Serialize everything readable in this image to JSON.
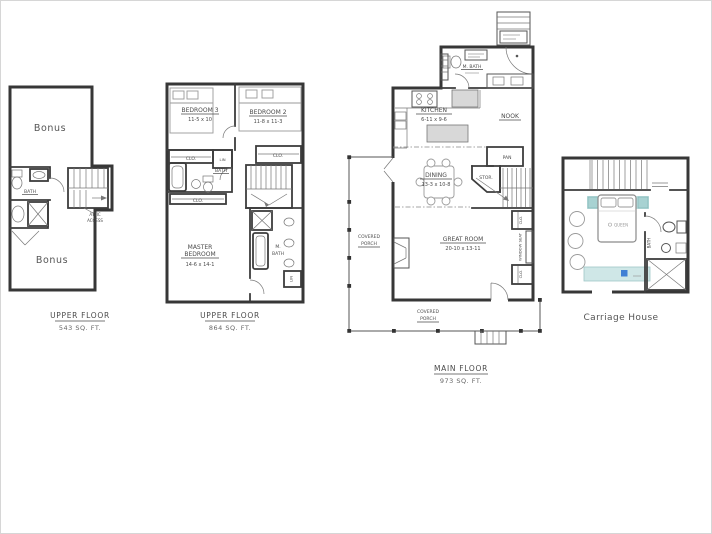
{
  "document": {
    "background": "#ffffff"
  },
  "plans": {
    "upper_small": {
      "title": "UPPER FLOOR",
      "area": "543 SQ. FT.",
      "rooms": {
        "bonus_top": "Bonus",
        "bonus_bottom": "Bonus",
        "bath": "BATH",
        "attic_line1": "ATTIC",
        "attic_line2": "ACCESS"
      }
    },
    "upper_large": {
      "title": "UPPER FLOOR",
      "area": "864 SQ. FT.",
      "rooms": {
        "bedroom3": "BEDROOM 3",
        "bedroom3_dim": "11-5 x 10",
        "bedroom2": "BEDROOM 2",
        "bedroom2_dim": "11-8 x 11-3",
        "clo_left": "CLO.",
        "lin": "LIN",
        "bath": "BATH",
        "clo_right": "CLO.",
        "master_clo": "CLO.",
        "master_line1": "MASTER",
        "master_line2": "BEDROOM",
        "master_dim": "14-6 x 14-1",
        "mbath_line1": "M.",
        "mbath_line2": "BATH",
        "mbath_lin": "LIN"
      }
    },
    "main": {
      "title": "MAIN FLOOR",
      "area": "973 SQ. FT.",
      "rooms": {
        "kitchen": "KITCHEN",
        "kitchen_dim": "6-11 x 9-6",
        "nook": "NOOK",
        "pantry": "PAN",
        "dining": "DINING",
        "dining_dim": "13-3 x 10-8",
        "storage": "STOR.",
        "main_bath": "M. BATH",
        "great_room": "GREAT ROOM",
        "great_room_dim": "20-10 x 13-11",
        "clo_top": "CLO.",
        "clo_bottom": "CLO.",
        "window_seat": "WINDOW SEAT",
        "porch_side_line1": "COVERED",
        "porch_side_line2": "PORCH",
        "porch_bottom_line1": "COVERED",
        "porch_bottom_line2": "PORCH"
      }
    },
    "carriage": {
      "title": "Carriage House",
      "rooms": {
        "bed": "QUEEN",
        "bath": "BATH"
      }
    }
  },
  "colors": {
    "wall": "#373737",
    "text": "#4a4a4a",
    "teal": "#bfdfdf",
    "teal_dark": "#a8d2d2",
    "accent_blue": "#3f7fd4",
    "appliance_gray": "#d8d8d8"
  }
}
